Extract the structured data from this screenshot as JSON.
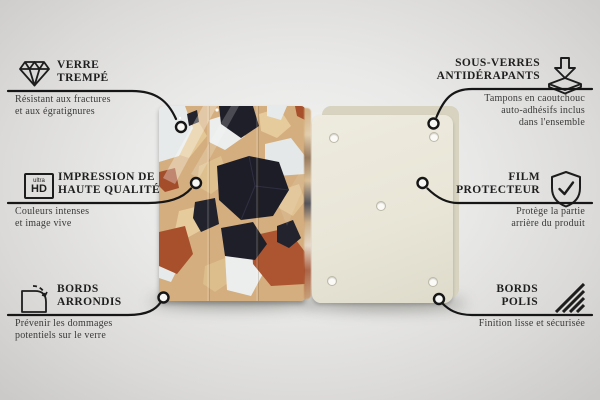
{
  "scene": {
    "description_type": "product-feature-infographic",
    "background_color": "#e9e9e8",
    "line_color": "#161616",
    "text_color": "#1f1f1f"
  },
  "product": {
    "front": {
      "name": "terrazzo-glass-board-front",
      "palette": {
        "base": "#d4ae7e",
        "black": "#1f1f29",
        "white": "#e7eaea",
        "terracotta": "#a8502c",
        "light_tan": "#e3c795"
      }
    },
    "back": {
      "name": "board-back",
      "color": "#e9e6d8",
      "edge_color": "#d7d3c0",
      "pad_count": 5
    }
  },
  "callouts": [
    {
      "id": "verre-trempe",
      "side": "left",
      "icon": "diamond-icon",
      "title": "VERRE\nTREMPÉ",
      "description": "Résistant aux fractures\net aux égratignures"
    },
    {
      "id": "impression-haute-qualite",
      "side": "left",
      "icon": "ultra-hd-icon",
      "title": "IMPRESSION DE\nHAUTE QUALITÉ",
      "description": "Couleurs intenses\net image vive",
      "badge": {
        "top": "ultra",
        "bottom": "HD"
      }
    },
    {
      "id": "bords-arrondis",
      "side": "left",
      "icon": "rounded-corner-icon",
      "title": "BORDS\nARRONDIS",
      "description": "Prévenir les dommages\npotentiels sur le verre"
    },
    {
      "id": "sous-verres-antiderapants",
      "side": "right",
      "icon": "anti-slip-pad-icon",
      "title": "SOUS-VERRES\nANTIDÉRAPANTS",
      "description": "Tampons en caoutchouc\nauto-adhésifs inclus\ndans l'ensemble"
    },
    {
      "id": "film-protecteur",
      "side": "right",
      "icon": "shield-check-icon",
      "title": "FILM\nPROTECTEUR",
      "description": "Protège la partie\narrière du produit"
    },
    {
      "id": "bords-polis",
      "side": "right",
      "icon": "polished-edge-icon",
      "title": "BORDS\nPOLIS",
      "description": "Finition lisse et sécurisée"
    }
  ]
}
